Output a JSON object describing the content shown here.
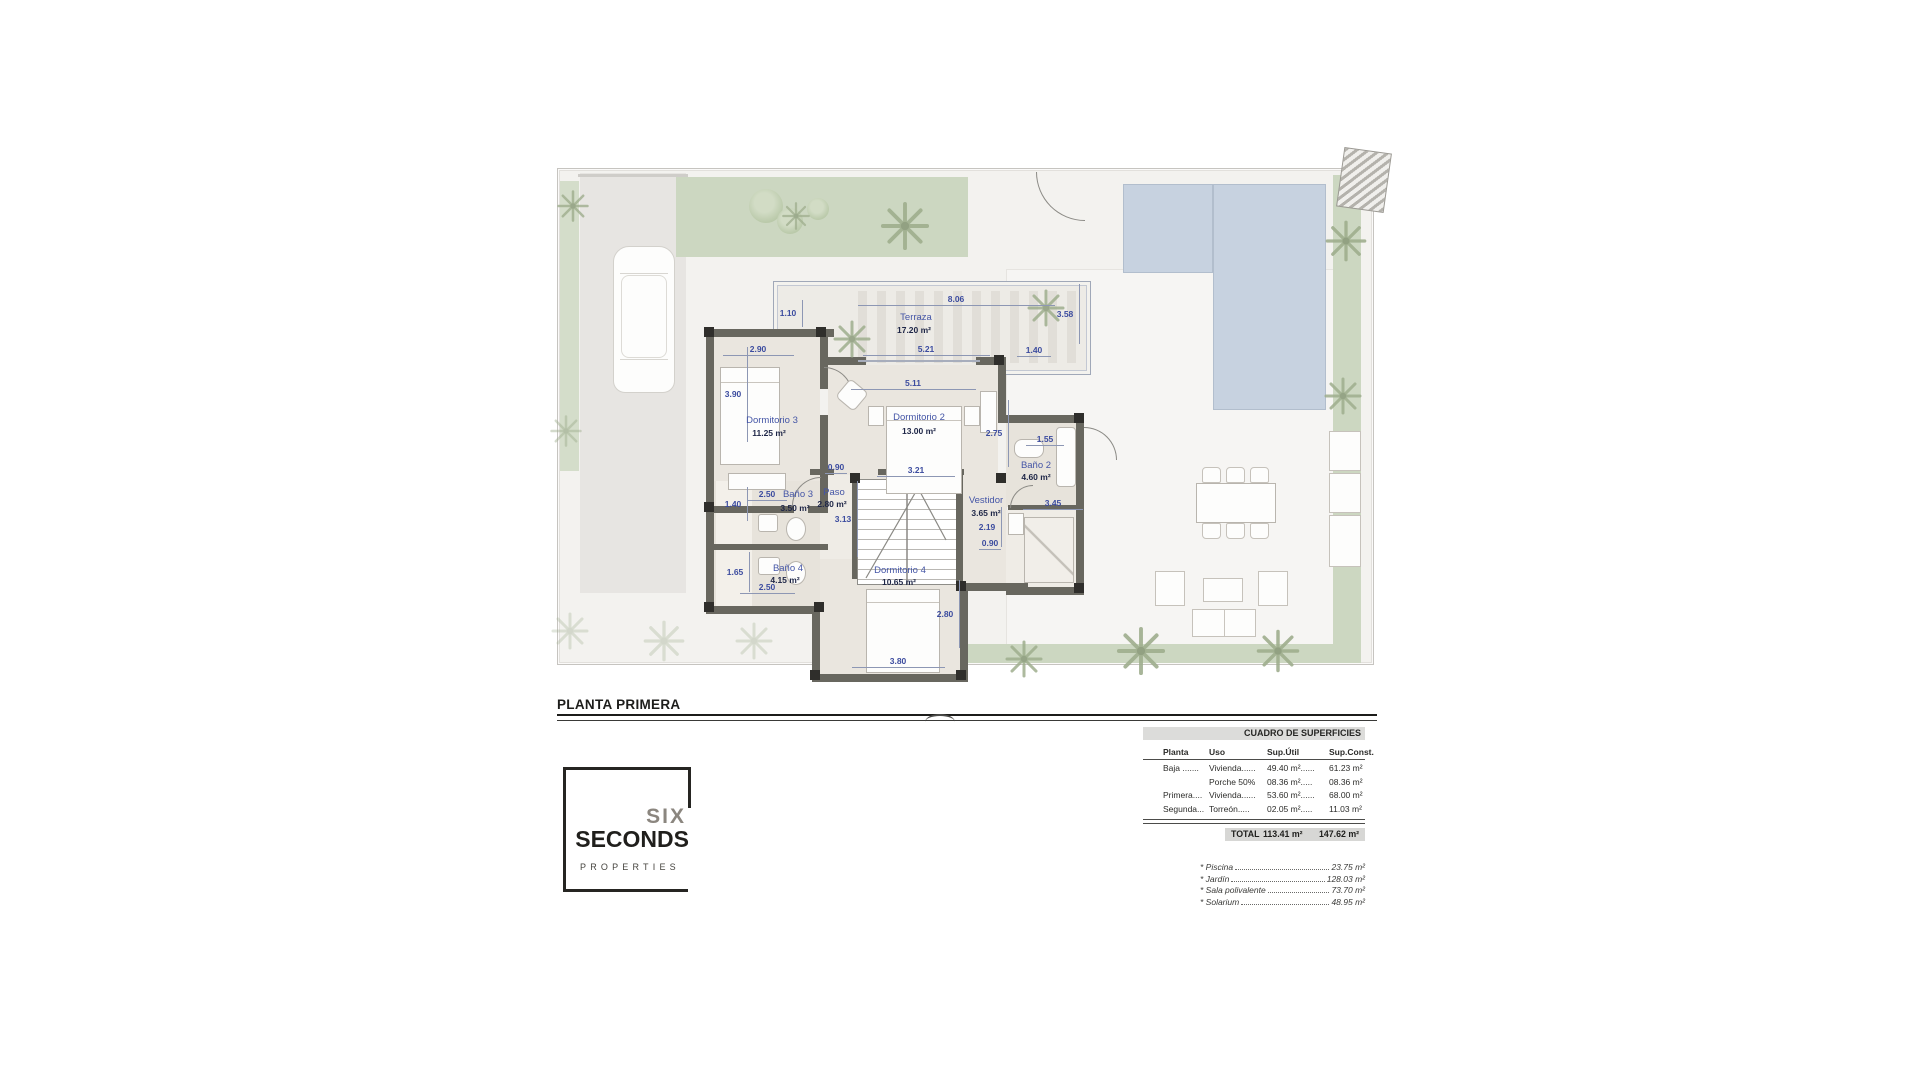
{
  "plan": {
    "title": "PLANTA PRIMERA",
    "labels": [
      {
        "t": "8.06",
        "x": 398,
        "y": 126,
        "c": "dim",
        "o": "h",
        "len": 197
      },
      {
        "t": "1.10",
        "x": 230,
        "y": 140,
        "c": "dim",
        "o": "v",
        "len": 27
      },
      {
        "t": "Terraza",
        "x": 358,
        "y": 144,
        "c": "room"
      },
      {
        "t": "17.20 m²",
        "x": 356,
        "y": 157,
        "c": "area"
      },
      {
        "t": "3.58",
        "x": 507,
        "y": 141,
        "c": "dim",
        "o": "v",
        "len": 60
      },
      {
        "t": "2.90",
        "x": 200,
        "y": 176,
        "c": "dim",
        "o": "h",
        "len": 71
      },
      {
        "t": "5.21",
        "x": 368,
        "y": 176,
        "c": "dim",
        "o": "h",
        "len": 127
      },
      {
        "t": "1.40",
        "x": 476,
        "y": 177,
        "c": "dim",
        "o": "h",
        "len": 34
      },
      {
        "t": "5.11",
        "x": 355,
        "y": 210,
        "c": "dim",
        "o": "h",
        "len": 125
      },
      {
        "t": "3.90",
        "x": 175,
        "y": 221,
        "c": "dim",
        "o": "v",
        "len": 95
      },
      {
        "t": "Dormitorio 3",
        "x": 214,
        "y": 247,
        "c": "room"
      },
      {
        "t": "11.25 m²",
        "x": 211,
        "y": 260,
        "c": "area"
      },
      {
        "t": "Dormitorio 2",
        "x": 361,
        "y": 244,
        "c": "room"
      },
      {
        "t": "13.00 m²",
        "x": 361,
        "y": 258,
        "c": "area"
      },
      {
        "t": "2.75",
        "x": 436,
        "y": 260,
        "c": "dim",
        "o": "v",
        "len": 67
      },
      {
        "t": "1.55",
        "x": 487,
        "y": 266,
        "c": "dim",
        "o": "h",
        "len": 38
      },
      {
        "t": "0.90",
        "x": 278,
        "y": 294,
        "c": "dim",
        "o": "h",
        "len": 22
      },
      {
        "t": "3.21",
        "x": 358,
        "y": 297,
        "c": "dim",
        "o": "h",
        "len": 78
      },
      {
        "t": "Baño 2",
        "x": 478,
        "y": 292,
        "c": "room"
      },
      {
        "t": "4.60 m²",
        "x": 478,
        "y": 304,
        "c": "area"
      },
      {
        "t": "2.50",
        "x": 209,
        "y": 321,
        "c": "dim",
        "o": "h",
        "len": 40
      },
      {
        "t": "Baño 3",
        "x": 240,
        "y": 321,
        "c": "room"
      },
      {
        "t": "3.50 m²",
        "x": 237,
        "y": 335,
        "c": "area"
      },
      {
        "t": "Paso",
        "x": 276,
        "y": 319,
        "c": "room"
      },
      {
        "t": "2.80 m²",
        "x": 274,
        "y": 331,
        "c": "area"
      },
      {
        "t": "1.40",
        "x": 175,
        "y": 331,
        "c": "dim",
        "o": "v",
        "len": 34
      },
      {
        "t": "3.13",
        "x": 285,
        "y": 346,
        "c": "dim",
        "o": "v",
        "len": 76
      },
      {
        "t": "Vestidor",
        "x": 428,
        "y": 327,
        "c": "room"
      },
      {
        "t": "3.65 m²",
        "x": 428,
        "y": 340,
        "c": "area"
      },
      {
        "t": "3.45",
        "x": 495,
        "y": 330,
        "c": "dim",
        "o": "h",
        "len": 60
      },
      {
        "t": "2.19",
        "x": 429,
        "y": 354,
        "c": "dim",
        "o": "v",
        "len": 40
      },
      {
        "t": "0.90",
        "x": 432,
        "y": 370,
        "c": "dim",
        "o": "h",
        "len": 22
      },
      {
        "t": "1.65",
        "x": 177,
        "y": 399,
        "c": "dim",
        "o": "v",
        "len": 40
      },
      {
        "t": "Baño 4",
        "x": 230,
        "y": 395,
        "c": "room"
      },
      {
        "t": "4.15 m²",
        "x": 227,
        "y": 407,
        "c": "area"
      },
      {
        "t": "2.50",
        "x": 209,
        "y": 414,
        "c": "dim",
        "o": "h",
        "len": 55
      },
      {
        "t": "Dormitorio 4",
        "x": 342,
        "y": 397,
        "c": "room"
      },
      {
        "t": "10.65 m²",
        "x": 341,
        "y": 409,
        "c": "area"
      },
      {
        "t": "2.80",
        "x": 387,
        "y": 441,
        "c": "dim",
        "o": "v",
        "len": 68
      },
      {
        "t": "3.80",
        "x": 340,
        "y": 488,
        "c": "dim",
        "o": "h",
        "len": 93
      }
    ]
  },
  "surfaces_table": {
    "title": "CUADRO DE SUPERFICIES",
    "columns": [
      "Planta",
      "Uso",
      "Sup.Útil",
      "Sup.Const."
    ],
    "rows": [
      {
        "planta": "Baja .......",
        "uso": "Vivienda......",
        "util": "49.40 m²......",
        "const": "61.23 m²"
      },
      {
        "planta": "",
        "uso": "Porche 50%",
        "util": "08.36 m².....",
        "const": "08.36 m²"
      },
      {
        "planta": "Primera....",
        "uso": "Vivienda......",
        "util": "53.60 m²......",
        "const": "68.00 m²"
      },
      {
        "planta": "Segunda...",
        "uso": "Torreón.....",
        "util": "02.05 m².....",
        "const": "11.03 m²"
      }
    ],
    "total": {
      "label": "TOTAL",
      "util": "113.41 m²",
      "const": "147.62 m²"
    },
    "extras": [
      {
        "name": "* Piscina",
        "value": "23.75 m²"
      },
      {
        "name": "* Jardín",
        "value": "128.03 m²"
      },
      {
        "name": "* Sala polivalente",
        "value": "73.70 m²"
      },
      {
        "name": "* Solarium",
        "value": "48.95 m²"
      }
    ]
  },
  "logo": {
    "line1": "SIX",
    "line2": "SECONDS",
    "line3": "PROPERTIES"
  }
}
